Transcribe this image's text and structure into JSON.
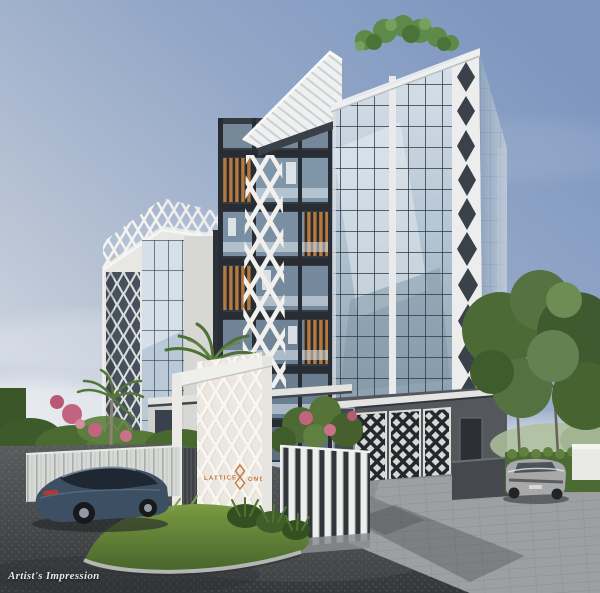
{
  "meta": {
    "caption": "Artist's Impression"
  },
  "signage": {
    "name_left": "LATTICE",
    "name_right": "ONE",
    "logo": "lattice-knot-logo"
  },
  "colors": {
    "sky_top": "#7d95bf",
    "sky_light": "#dfe5ea",
    "building_white": "#e7e7e4",
    "frame_charcoal": "#353b42",
    "wood_accent": "#b5793f",
    "glass_blue": "#b9c9d6",
    "glass_deep": "#8aa0b3",
    "lattice_white": "#f1f0ed",
    "sign_orange": "#c4763c",
    "greenery": "#567338",
    "grass": "#68893c",
    "asphalt": "#45474a",
    "paver_gray": "#9da0a2",
    "car_left_blue": "#3d4f62",
    "car_right_silver": "#a7a8a7"
  }
}
